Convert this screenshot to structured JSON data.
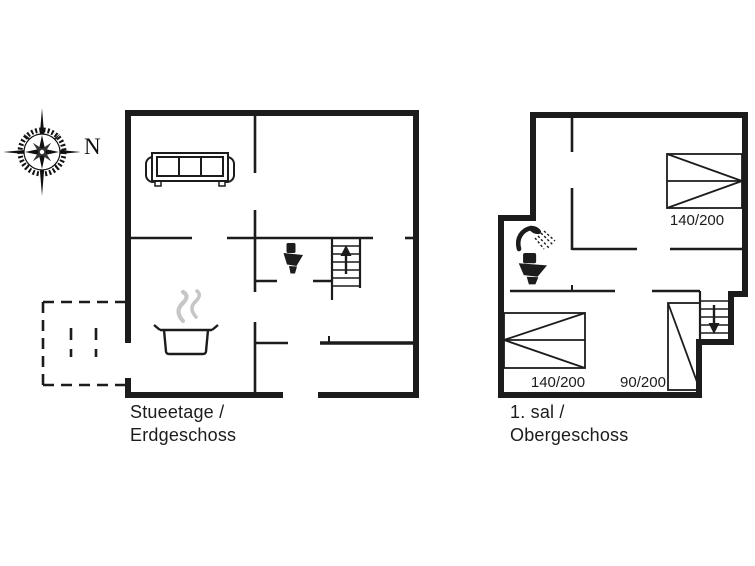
{
  "canvas": {
    "bg": "#ffffff",
    "ink": "#1c1c1c",
    "steam_color": "#c6c6c6"
  },
  "compass": {
    "label": "N",
    "icon": "compass-rose-icon"
  },
  "ground_floor": {
    "name_line1": "Stueetage /",
    "name_line2": "Erdgeschoss",
    "icons": [
      "sofa-icon",
      "toilet-icon",
      "staircase-up-icon",
      "cooking-pot-icon",
      "steam-icon",
      "terrace-dashed-outline"
    ]
  },
  "upper_floor": {
    "name_line1": "1. sal /",
    "name_line2": "Obergeschoss",
    "icons": [
      "shower-icon",
      "toilet-icon",
      "staircase-down-icon"
    ],
    "bed_labels": {
      "bed_top_right": "140/200",
      "bed_bottom_left": "140/200",
      "bed_bottom_right": "90/200"
    }
  }
}
